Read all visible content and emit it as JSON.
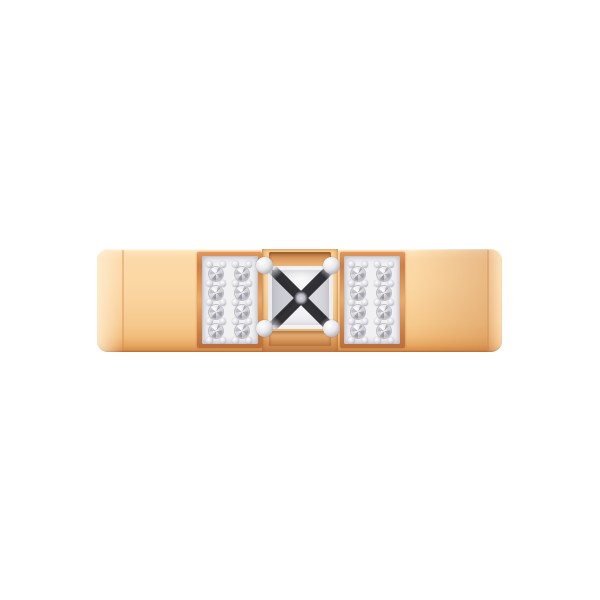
{
  "scene": {
    "type": "product-photo",
    "subject": "diamond ring",
    "description": "Front view of a rose gold flat band ring with a princess-cut center diamond held by four white-gold prongs, flanked by two rectangular white-gold pave panels, each set with eight small round diamonds arranged in two columns of four",
    "metal": "rose gold",
    "setting_metal": "white gold",
    "background": "white"
  },
  "colors": {
    "gold-light": "#fde4bd",
    "gold-face": "#fbd7a2",
    "gold-mid": "#f7cd92",
    "gold-deep": "#eab06d",
    "gold-shadow": "#d18a4e",
    "frame-gold": "#c97d45",
    "metal-white": "#eeeef2",
    "metal-gray": "#a9a9b2",
    "stone-light": "#f2f2f5",
    "stone-gray": "#cfcfd6",
    "stone-dark": "#26262a"
  },
  "center_stone": {
    "cut": "princess",
    "count": 1,
    "prongs": 4
  },
  "pave": {
    "stone_cut": "round",
    "stones_per_panel": 8,
    "total_stones": 16,
    "rows": 4,
    "columns_per_panel": 2,
    "panels": [
      {
        "side": "left",
        "columns_x": [
          216,
          242
        ]
      },
      {
        "side": "right",
        "columns_x": [
          358,
          384
        ]
      }
    ],
    "first_row_y": 274,
    "row_spacing": 19,
    "stone_diameter": 14.5,
    "bead_diameter": 6.5
  }
}
